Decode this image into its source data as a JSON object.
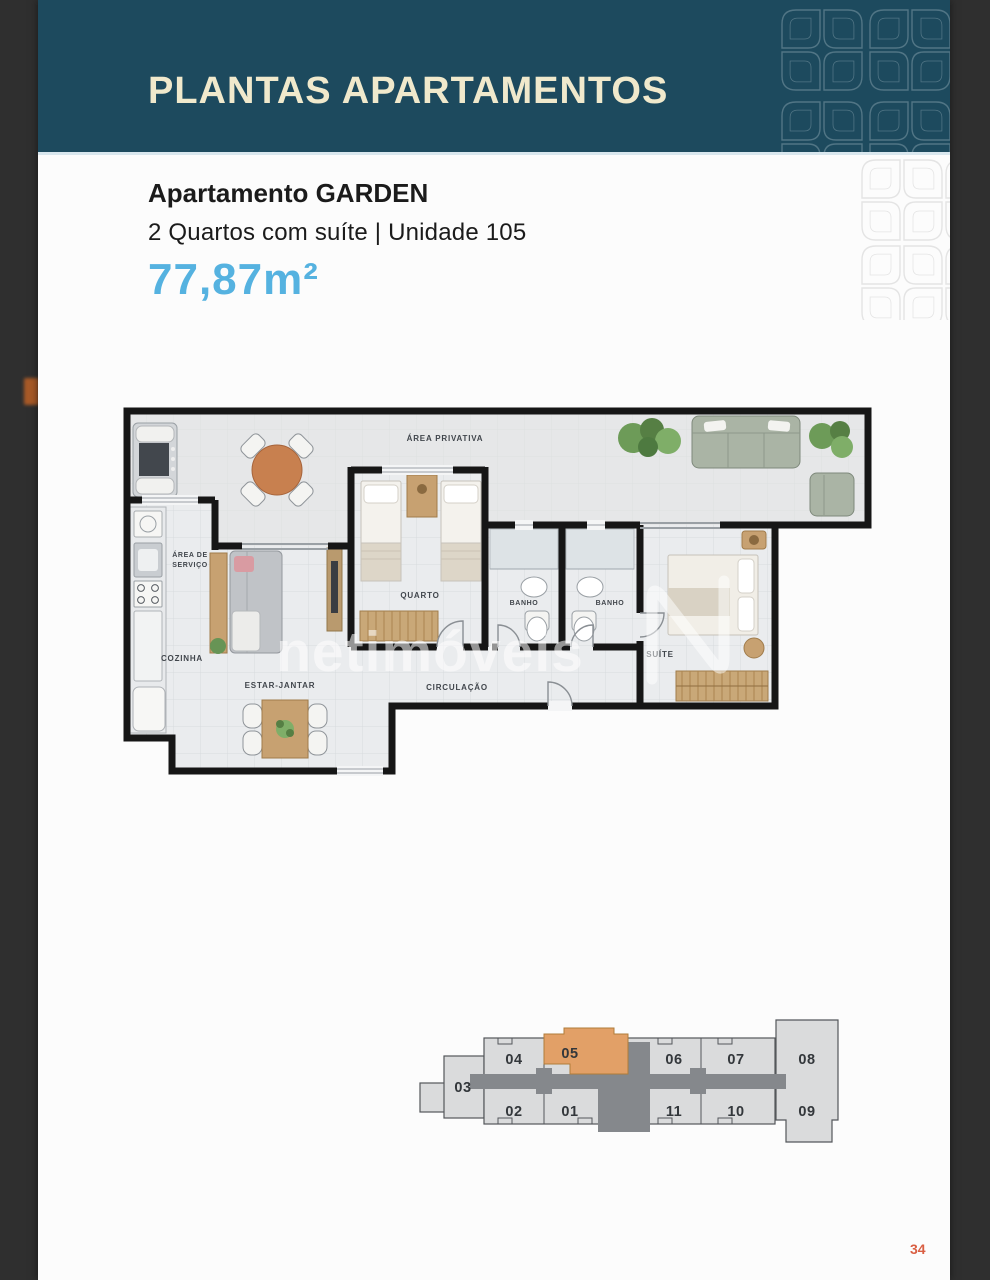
{
  "header": {
    "title": "PLANTAS APARTAMENTOS"
  },
  "apartment": {
    "title": "Apartamento GARDEN",
    "subtitle": "2 Quartos com suíte | Unidade 105",
    "area": "77,87m²"
  },
  "floor_plan": {
    "watermark": "netimóveis",
    "labels": {
      "area_privativa": "ÁREA PRIVATIVA",
      "area_de": "ÁREA DE",
      "servico": "SERVIÇO",
      "quarto": "QUARTO",
      "banho_1": "BANHO",
      "banho_2": "BANHO",
      "cozinha": "COZINHA",
      "estar_jantar": "ESTAR-JANTAR",
      "circulacao": "CIRCULAÇÃO",
      "suite": "SUÍTE"
    }
  },
  "unit_map": {
    "highlighted_unit": "05",
    "units": [
      {
        "label": "03"
      },
      {
        "label": "04"
      },
      {
        "label": "05"
      },
      {
        "label": "06"
      },
      {
        "label": "07"
      },
      {
        "label": "08"
      },
      {
        "label": "02"
      },
      {
        "label": "01"
      },
      {
        "label": "11"
      },
      {
        "label": "10"
      },
      {
        "label": "09"
      }
    ]
  },
  "footer": {
    "page_number": "34"
  },
  "colors": {
    "header_teal": "#1d4a5e",
    "header_text": "#f0e9cc",
    "area_blue": "#55b2e0",
    "highlight_orange": "#e2a067",
    "page_number_orange": "#d95f43"
  }
}
